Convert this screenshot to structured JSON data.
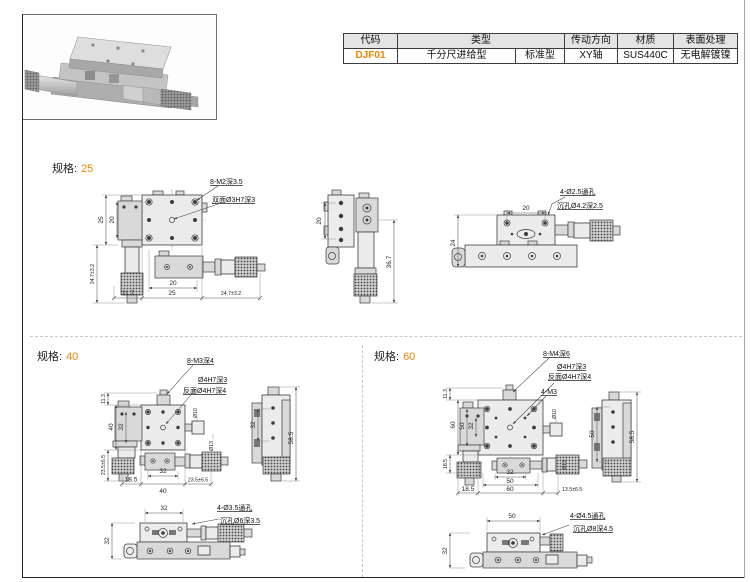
{
  "accent_color": "#f08300",
  "spec_table": {
    "h_code": "代码",
    "h_type": "类型",
    "h_drive": "传动方向",
    "h_material": "材质",
    "h_finish": "表面处理",
    "v_code": "DJF01",
    "v_type_main": "千分尺进给型",
    "v_type_sub": "标准型",
    "v_drive": "XY轴",
    "v_material": "SUS440C",
    "v_finish": "无电解镀镍"
  },
  "sections": {
    "s25": {
      "label": "规格:",
      "size": "25",
      "top": {
        "ann_holes": "8-M2深3.5",
        "ann_center": "双面Ø3H7深3",
        "left_outer": "25",
        "left_inner": "20",
        "left_lower": "24.7±3.2",
        "bottom_inner": "20",
        "bottom_a": "11.7",
        "bottom_b": "25",
        "bottom_c": "24.7±3.2"
      },
      "side": {
        "left": "20",
        "right": "36.7"
      },
      "front": {
        "top": "20",
        "left": "24",
        "ann_a": "4-Ø2.5通孔",
        "ann_b": "沉孔Ø4.2深2.5"
      }
    },
    "s40": {
      "label": "规格:",
      "size": "40",
      "top": {
        "ann_holes": "8-M3深4",
        "ann_pin": "Ø4H7深3",
        "ann_pin_back": "反面Ø4H7深4",
        "left_a": "11.3",
        "left_b": "40",
        "left_c": "32",
        "left_d": "23.5±6.5",
        "bottom_a": "32",
        "bottom_b": "18.5",
        "bottom_c": "40",
        "bottom_d": "23.5±6.5",
        "right_a": "Ø10",
        "right_b": "Ø13"
      },
      "side": {
        "a": "32",
        "b": "58.5"
      },
      "bottom": {
        "top": "32",
        "left": "32",
        "ann_a": "4-Ø3.5通孔",
        "ann_b": "沉孔Ø6深3.5"
      }
    },
    "s60": {
      "label": "规格:",
      "size": "60",
      "top": {
        "ann_holes": "8-M4深6",
        "ann_pin": "Ø4H7深3",
        "ann_pin_back": "反面Ø4H7深4",
        "ann_m3": "4-M3",
        "left_a": "11.3",
        "left_b": "60",
        "left_c": "50",
        "left_d": "32",
        "left_e": "18.5",
        "bottom_a": "32",
        "bottom_b": "50",
        "bottom_c": "18.5",
        "bottom_d": "60",
        "bottom_e": "13.5±6.5",
        "right_a": "Ø10",
        "right_b": "Ø13"
      },
      "side": {
        "a": "50",
        "b": "58.5"
      },
      "bottom": {
        "top": "50",
        "left": "32",
        "ann_a": "4-Ø4.5通孔",
        "ann_b": "沉孔Ø8深4.5"
      }
    }
  }
}
